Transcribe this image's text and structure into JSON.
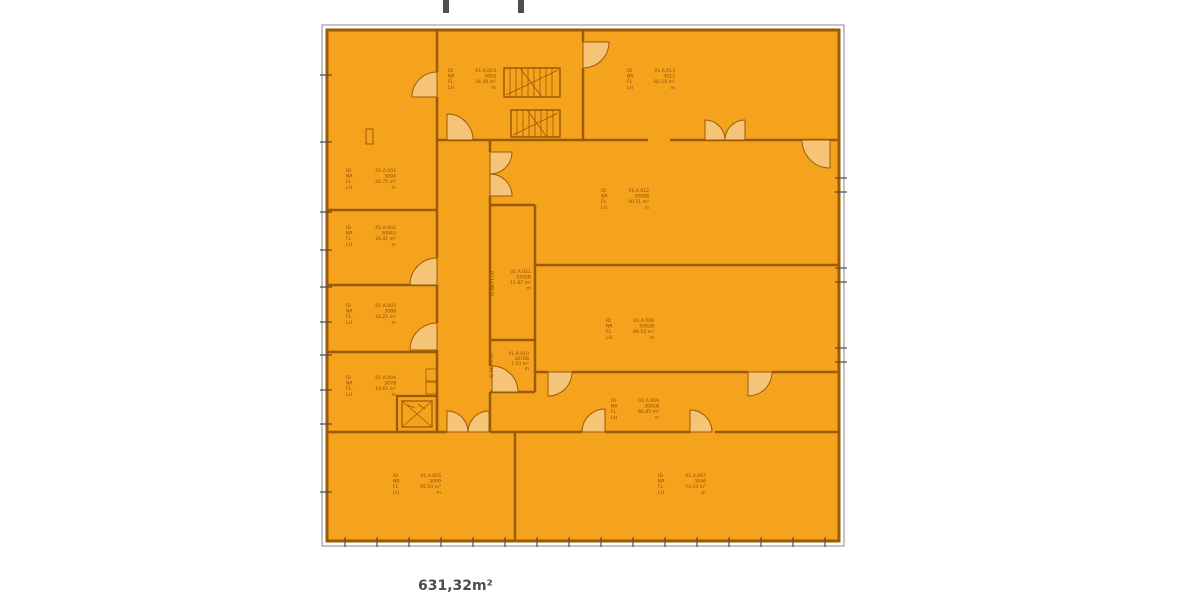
{
  "plan": {
    "total_area": "631,32m²",
    "labels": {
      "k1": "ID",
      "k2": "NR",
      "k3": "FL",
      "k4": "LH",
      "keys_line": "ID NR FL LH"
    },
    "rooms": [
      {
        "id": "01.A.001",
        "nr": "3094",
        "fl": "42.75 m²",
        "lh": "m"
      },
      {
        "id": "01.A.002",
        "nr": "3084A",
        "fl": "16.41 m²",
        "lh": "m"
      },
      {
        "id": "01.A.003",
        "nr": "3080",
        "fl": "16.21 m²",
        "lh": "m"
      },
      {
        "id": "01.A.004",
        "nr": "3078",
        "fl": "14.61 m²",
        "lh": "m"
      },
      {
        "id": "01.A.005",
        "nr": "3099",
        "fl": "45.54 m²",
        "lh": "m"
      },
      {
        "id": "01.A.007",
        "nr": "3046",
        "fl": "73.14 m²",
        "lh": "m"
      },
      {
        "id": "01.A.008",
        "nr": "3092B",
        "fl": "89.53 m²",
        "lh": "m"
      },
      {
        "id": "01.A.009",
        "nr": "3042B",
        "fl": "66.85 m²",
        "lh": "m"
      },
      {
        "id": "01.A.010",
        "nr": "3070B",
        "fl": "7.53 m²",
        "lh": "m"
      },
      {
        "id": "01.A.011",
        "nr": "3305B",
        "fl": "11.87 m²",
        "lh": "m"
      },
      {
        "id": "01.A.012",
        "nr": "3090B",
        "fl": "90.11 m²",
        "lh": "m"
      },
      {
        "id": "01.A.013",
        "nr": "3012",
        "fl": "82.18 m²",
        "lh": "m"
      },
      {
        "id": "01.A.014",
        "nr": "3093",
        "fl": "34.39 m²",
        "lh": "m"
      }
    ],
    "colors": {
      "room_fill": "#f5a21c",
      "wall": "#9d5a05",
      "door_fill": "#f6c477",
      "label_text": "#8e4e00",
      "marks_gray": "#4f4f4f"
    }
  }
}
